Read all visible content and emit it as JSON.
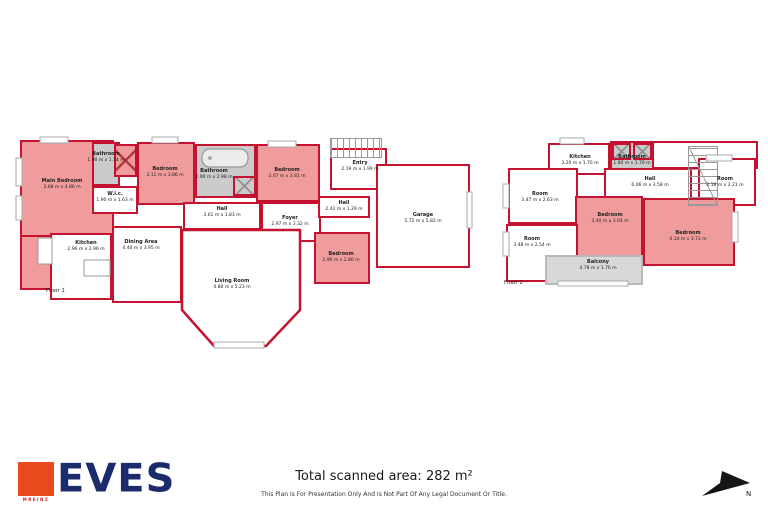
{
  "colors": {
    "wall": "#c41230",
    "room_fill": "#f19c9c",
    "wet_fill": "#cbcbcb",
    "balcony_fill": "#d8d8d8",
    "navy": "#1c2b6b",
    "orange": "#e8491d",
    "ink": "#1a1a1a"
  },
  "floor1": {
    "label": "Floor 1",
    "rooms": [
      {
        "name": "Main Bedroom",
        "dims": "3.68 m x 4.86 m"
      },
      {
        "name": "Bathroom",
        "dims": "1.90 m x 1.14 m"
      },
      {
        "name": "Bedroom",
        "dims": "3.11 m x 3.86 m"
      },
      {
        "name": "W.i.c.",
        "dims": "1.90 m x 1.63 m"
      },
      {
        "name": "Bathroom",
        "dims": "2.90 m x 2.98 m"
      },
      {
        "name": "Bedroom",
        "dims": "3.07 m x 3.81 m"
      },
      {
        "name": "Hall",
        "dims": "3.61 m x 1.83 m"
      },
      {
        "name": "Foyer",
        "dims": "2.97 m x 3.32 m"
      },
      {
        "name": "Entry",
        "dims": "2.19 m x 1.99 m"
      },
      {
        "name": "Hall",
        "dims": "2.42 m x 1.29 m"
      },
      {
        "name": "Garage",
        "dims": "5.72 m x 5.82 m"
      },
      {
        "name": "Bedroom",
        "dims": "2.90 m x 2.80 m"
      },
      {
        "name": "Kitchen",
        "dims": "2.96 m x 2.96 m"
      },
      {
        "name": "Dining Area",
        "dims": "4.40 m x 3.95 m"
      },
      {
        "name": "Living Room",
        "dims": "4.80 m x 5.23 m"
      }
    ]
  },
  "floor2": {
    "label": "Floor 2",
    "rooms": [
      {
        "name": "Kitchen",
        "dims": "3.20 m x 1.76 m"
      },
      {
        "name": "Bathroom",
        "dims": "1.80 m x 1.79 m"
      },
      {
        "name": "Hall",
        "dims": "6.06 m x 3.58 m"
      },
      {
        "name": "Room",
        "dims": "2.18 m x 2.21 m"
      },
      {
        "name": "Room",
        "dims": "3.47 m x 2.63 m"
      },
      {
        "name": "Bedroom",
        "dims": "3.40 m x 3.04 m"
      },
      {
        "name": "Room",
        "dims": "3.48 m x 2.54 m"
      },
      {
        "name": "Bedroom",
        "dims": "4.14 m x 3.73 m"
      },
      {
        "name": "Balcony",
        "dims": "4.78 m x 1.76 m"
      }
    ]
  },
  "footer": {
    "logo_text": "EVES",
    "logo_sub": "MREINZ",
    "total_area": "Total scanned area: 282 m²",
    "disclaimer": "This Plan Is For Presentation Only And Is Not Part Of Any Legal Document Or Title.",
    "north_label": "N"
  }
}
